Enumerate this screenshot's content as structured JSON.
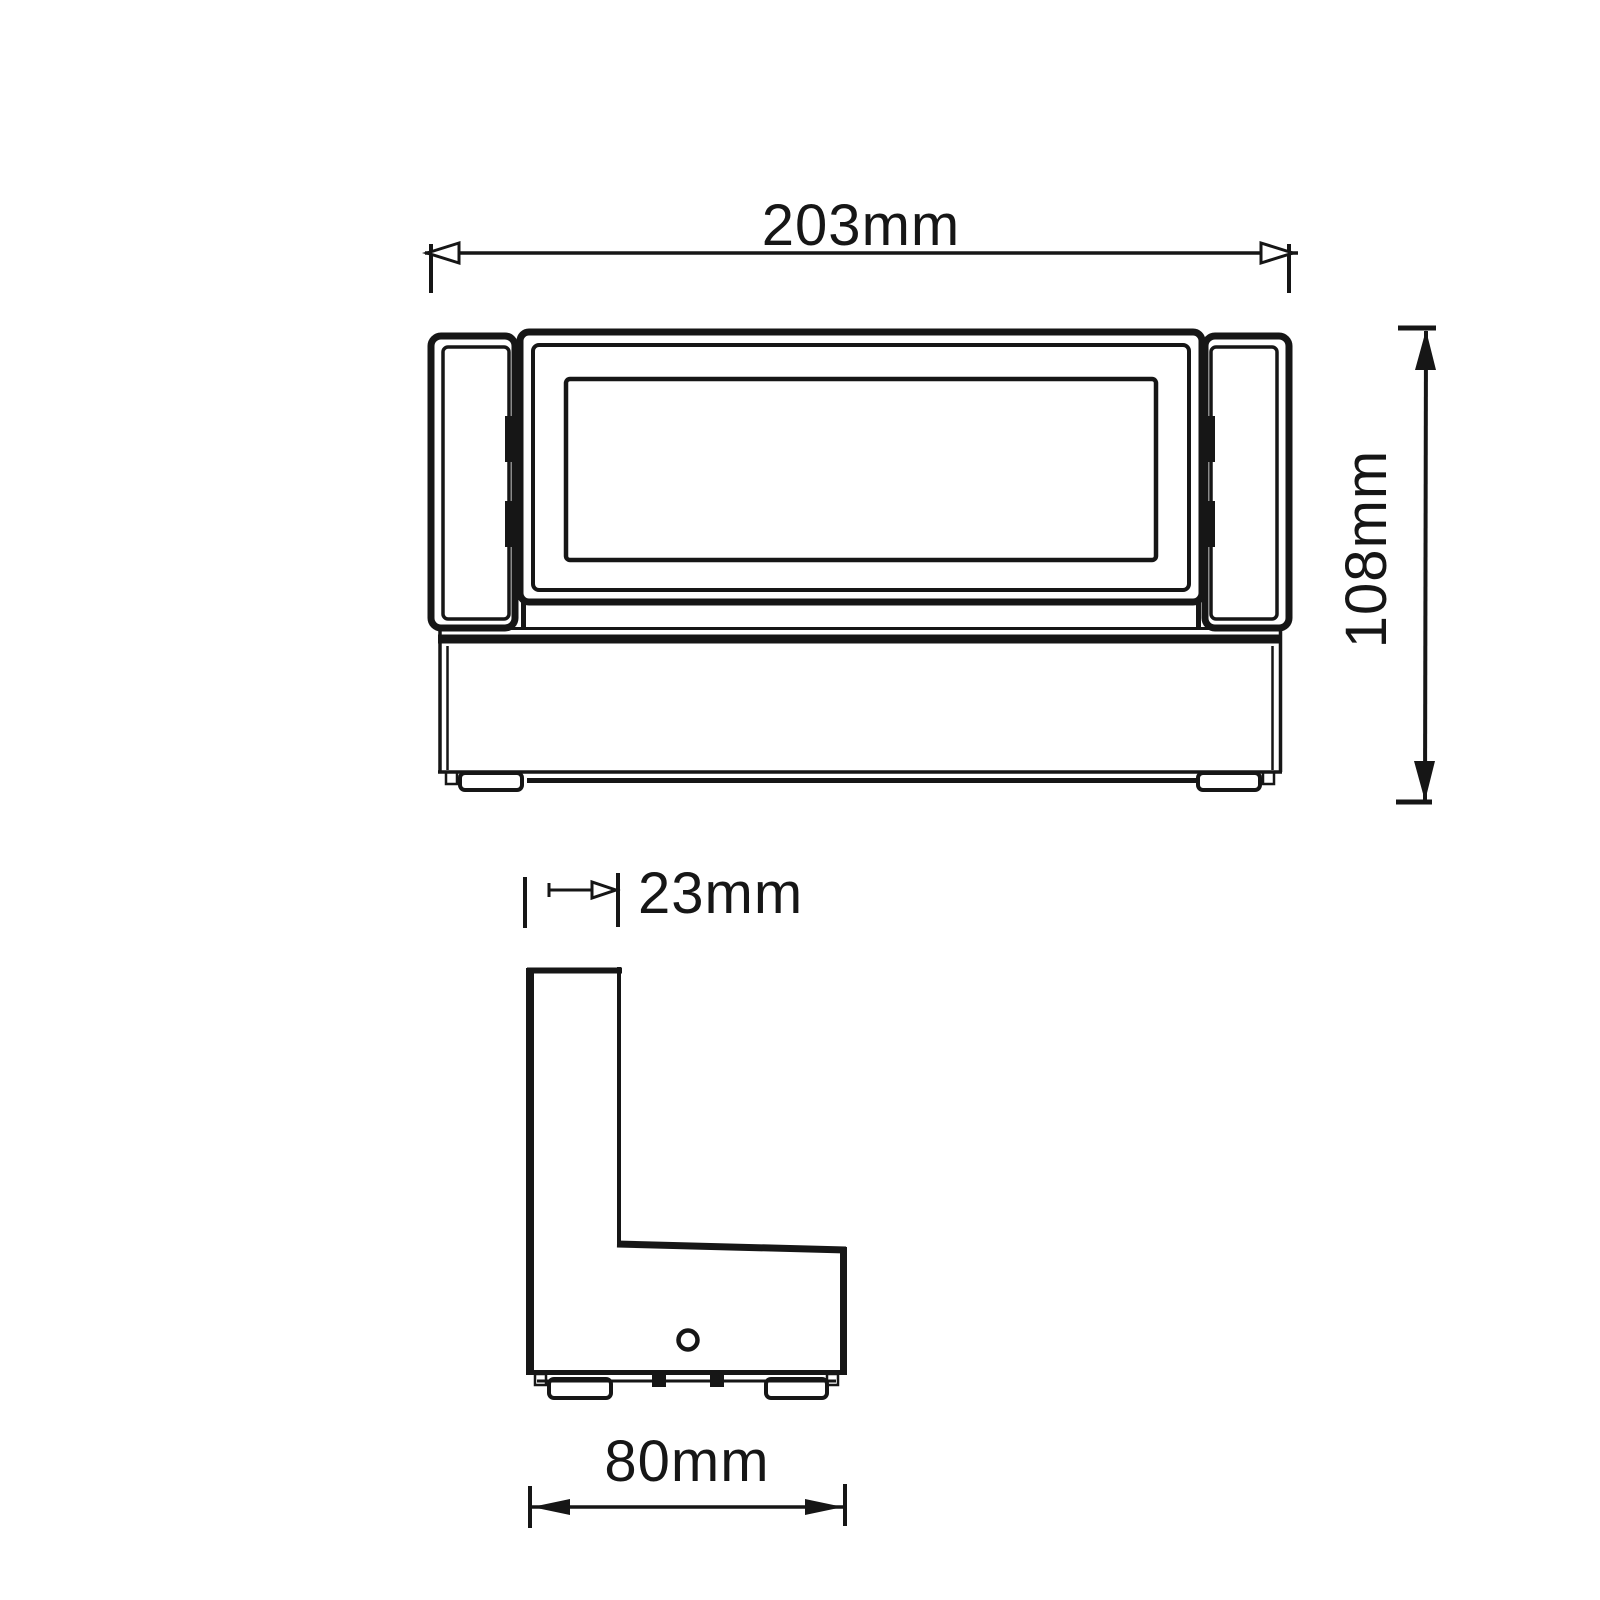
{
  "drawing": {
    "background_color": "#ffffff",
    "line_color": "#161616",
    "dimensions": {
      "overall_width": {
        "label": "203mm"
      },
      "overall_height": {
        "label": "108mm"
      },
      "panel_depth": {
        "label": "23mm"
      },
      "base_depth": {
        "label": "80mm"
      }
    }
  }
}
